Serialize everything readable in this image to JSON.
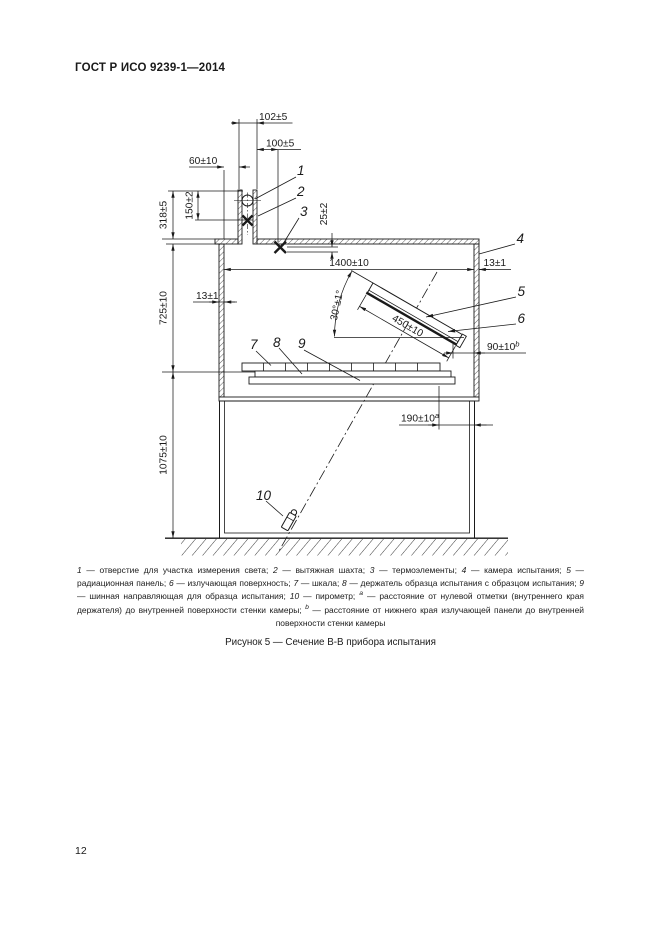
{
  "page": {
    "header_title": "ГОСТ Р ИСО 9239-1—2014",
    "page_number": "12",
    "figure_caption": "Рисунок 5 — Сечение В-В прибора испытания"
  },
  "figure": {
    "callouts": [
      "1",
      "2",
      "3",
      "4",
      "5",
      "6",
      "7",
      "8",
      "9",
      "10"
    ],
    "dimensions": {
      "shaft_width": "102±5",
      "shaft_to_thermocouple": "100±5",
      "wall_to_shaft": "60±10",
      "thermo_depth_in_shaft": "150±2",
      "shaft_height": "318±5",
      "thermo_below_ceiling": "25±2",
      "chamber_inner_width": "1400±10",
      "right_wall_thickness": "13±1",
      "left_wall_thickness": "13±1",
      "chamber_inner_height": "725±10",
      "panel_angle": "30°±1°",
      "panel_length": "450±10",
      "panel_to_wall": {
        "value": "90±10",
        "sup": "b"
      },
      "zero_mark_to_wall": {
        "value": "190±10",
        "sup": "a"
      },
      "stand_height": "1075±10"
    }
  },
  "legend": {
    "separator": " — ",
    "delimiter": "; ",
    "items": [
      {
        "marker": "1",
        "text": "отверстие для участка измерения света"
      },
      {
        "marker": "2",
        "text": "вытяжная шахта"
      },
      {
        "marker": "3",
        "text": "термоэлементы"
      },
      {
        "marker": "4",
        "text": "камера испытания"
      },
      {
        "marker": "5",
        "text": "радиационная панель"
      },
      {
        "marker": "6",
        "text": "излучающая поверхность"
      },
      {
        "marker": "7",
        "text": "шкала"
      },
      {
        "marker": "8",
        "text": "держатель образца испытания с образцом испытания"
      },
      {
        "marker": "9",
        "text": "шинная направляющая для образца испытания"
      },
      {
        "marker": "10",
        "text": "пирометр"
      },
      {
        "marker": "a",
        "sup": true,
        "text": "расстояние от нулевой отметки (внутреннего края держателя) до внутренней поверхности стенки камеры"
      },
      {
        "marker": "b",
        "sup": true,
        "text": "расстояние от нижнего края излучающей панели до внутренней поверхности стенки камеры"
      }
    ]
  }
}
